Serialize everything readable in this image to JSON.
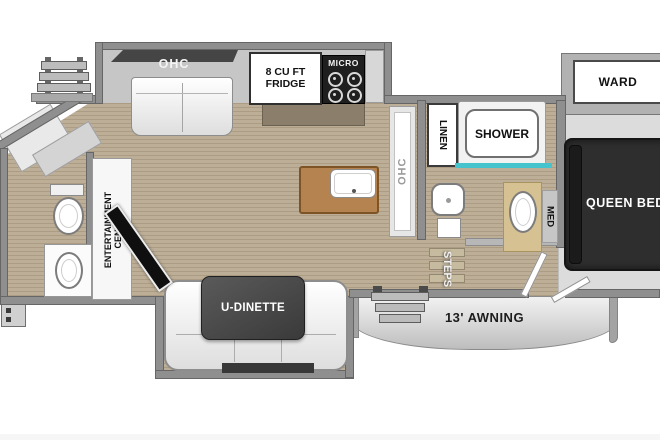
{
  "labels": {
    "galley_ohc": "OHC",
    "fridge": "8 CU FT FRIDGE",
    "micro": "MICRO",
    "kitchen_ohc": "OHC",
    "linen": "LINEN",
    "shower": "SHOWER",
    "ward": "WARD",
    "queen_bed": "QUEEN BED",
    "med": "MED",
    "steps": "STEPS",
    "entertainment_center": "ENTERTAINMENT CENTER",
    "u_dinette": "U-DINETTE",
    "awning": "13' AWNING"
  },
  "colors": {
    "background": "#ffffff",
    "wall_gray": "#8f8f8f",
    "floor_wood": "#b7a991",
    "island_wood": "#b5834f",
    "bed_charcoal": "#2e2e2e",
    "table_gray": "#454545",
    "shower_glass_teal": "#46c4cd"
  }
}
